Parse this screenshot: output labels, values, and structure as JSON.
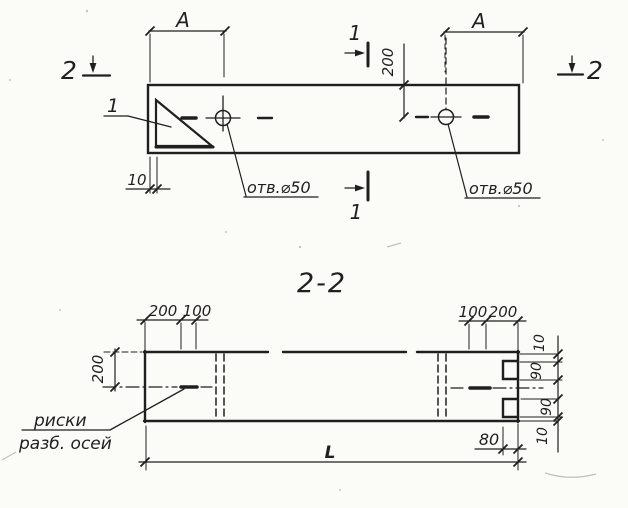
{
  "colors": {
    "ink": "#1f1f1f",
    "paper": "#fbfbf8"
  },
  "plan": {
    "dim_a_left": "A",
    "dim_a_right": "A",
    "dim_depth": "200",
    "dim_edge": "10",
    "hole1_label": "отв.⌀50",
    "hole2_label": "отв.⌀50",
    "detail_callout": "1",
    "section1_top": "1",
    "section1_bottom": "1",
    "section2_left": "2",
    "section2_right": "2"
  },
  "section": {
    "title": "2-2",
    "dims_top_left": {
      "a": "200",
      "b": "100"
    },
    "dims_top_right": {
      "a": "100",
      "b": "200"
    },
    "dim_height": "200",
    "dims_right": [
      "10",
      "90",
      "90",
      "10"
    ],
    "dim_notch": "80",
    "dim_length": "L",
    "note_line1": "риски",
    "note_line2": "разб. осей"
  }
}
